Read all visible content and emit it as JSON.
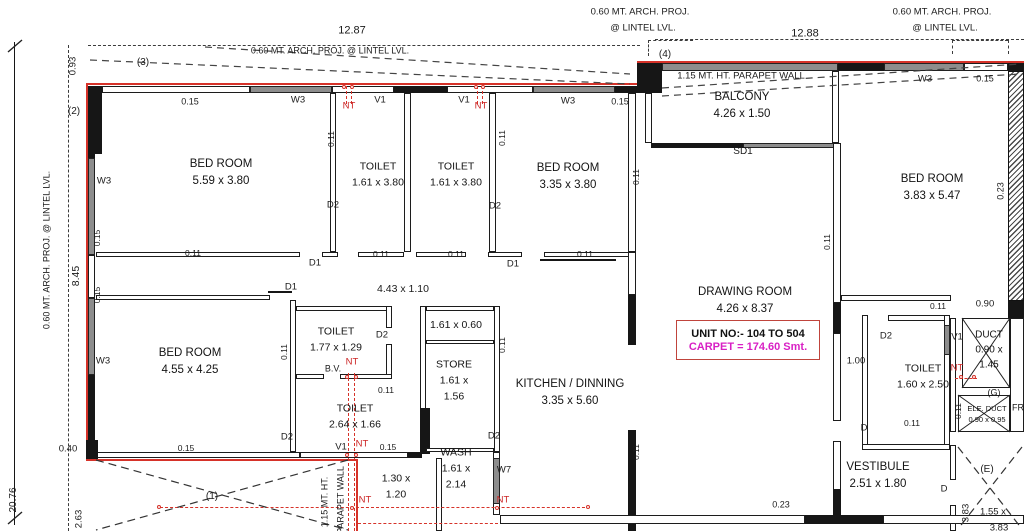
{
  "plan": {
    "unit_box": {
      "unit_no": "UNIT NO:-  104 TO 504",
      "carpet": "CARPET = 174.60 Smt."
    },
    "colors": {
      "wall_black": "#161616",
      "outer_red": "#d63229",
      "carpet_magenta": "#d81fc4",
      "window_gray": "#8d8d8d"
    },
    "rooms": [
      {
        "lines": [
          "BED ROOM",
          "5.59 x 3.80"
        ],
        "x": 221,
        "y": 173
      },
      {
        "lines": [
          "TOILET",
          "1.61 x 3.80"
        ],
        "x": 378,
        "y": 175,
        "f": 10.5
      },
      {
        "lines": [
          "TOILET",
          "1.61 x 3.80"
        ],
        "x": 456,
        "y": 175,
        "f": 10.5
      },
      {
        "lines": [
          "BED ROOM",
          "3.35 x 3.80"
        ],
        "x": 568,
        "y": 177
      },
      {
        "lines": [
          "BALCONY",
          "4.26 x 1.50"
        ],
        "x": 742,
        "y": 106
      },
      {
        "lines": [
          "DRAWING  ROOM",
          "4.26 x 8.37"
        ],
        "x": 745,
        "y": 301
      },
      {
        "lines": [
          "BED ROOM",
          "3.83 x 5.47"
        ],
        "x": 932,
        "y": 188
      },
      {
        "lines": [
          "BED ROOM",
          "4.55 x 4.25"
        ],
        "x": 190,
        "y": 362
      },
      {
        "lines": [
          "TOILET",
          "1.77 x 1.29"
        ],
        "x": 336,
        "y": 340,
        "f": 10.5
      },
      {
        "lines": [
          "TOILET",
          "2.64 x 1.66"
        ],
        "x": 355,
        "y": 417,
        "f": 10.5
      },
      {
        "lines": [
          "1.61 x 0.60"
        ],
        "x": 456,
        "y": 326,
        "f": 10.5
      },
      {
        "lines": [
          "STORE",
          "1.61 x",
          "1.56"
        ],
        "x": 454,
        "y": 381,
        "f": 10.5
      },
      {
        "lines": [
          "WASH",
          "1.61 x",
          "2.14"
        ],
        "x": 456,
        "y": 469,
        "f": 10.5
      },
      {
        "lines": [
          "1.30 x",
          "1.20"
        ],
        "x": 396,
        "y": 487,
        "f": 10.5
      },
      {
        "lines": [
          "KITCHEN / DINNING",
          "3.35 x 5.60"
        ],
        "x": 570,
        "y": 393
      },
      {
        "lines": [
          "TOILET",
          "1.60 x 2.50"
        ],
        "x": 923,
        "y": 377,
        "f": 10.5
      },
      {
        "lines": [
          "DUCT",
          "0.90 x",
          "1.45"
        ],
        "x": 989,
        "y": 350,
        "f": 10
      },
      {
        "lines": [
          "ELE. DUCT",
          "0.90 x 0.95"
        ],
        "x": 987,
        "y": 414,
        "f": 7.5
      },
      {
        "lines": [
          "VESTIBULE",
          "2.51 x 1.80"
        ],
        "x": 878,
        "y": 476
      }
    ],
    "labels": [
      {
        "t": "12.87",
        "x": 352,
        "y": 31,
        "f": 11
      },
      {
        "t": "0.60 MT. ARCH. PROJ. @ LINTEL LVL.",
        "x": 330,
        "y": 51,
        "f": 9
      },
      {
        "t": "(3)",
        "x": 143,
        "y": 63
      },
      {
        "t": "0.60 MT. ARCH. PROJ.",
        "x": 640,
        "y": 12,
        "f": 9.5
      },
      {
        "t": "@ LINTEL LVL.",
        "x": 643,
        "y": 28,
        "f": 9.5
      },
      {
        "t": "12.88",
        "x": 805,
        "y": 34,
        "f": 11
      },
      {
        "t": "(4)",
        "x": 665,
        "y": 55
      },
      {
        "t": "0.60 MT. ARCH. PROJ.",
        "x": 942,
        "y": 12,
        "f": 9.5
      },
      {
        "t": "@ LINTEL LVL.",
        "x": 945,
        "y": 28,
        "f": 9.5
      },
      {
        "t": "1.15 MT. HT. PARAPET WALL",
        "x": 741,
        "y": 76,
        "f": 9.5
      },
      {
        "t": "SD1",
        "x": 743,
        "y": 152
      },
      {
        "t": "0.93",
        "x": 73,
        "y": 66,
        "r": 1,
        "f": 9.5
      },
      {
        "t": "(2)",
        "x": 74,
        "y": 112
      },
      {
        "t": "0.15",
        "x": 190,
        "y": 102,
        "f": 9
      },
      {
        "t": "W3",
        "x": 298,
        "y": 100,
        "f": 9.5
      },
      {
        "t": "V1",
        "x": 380,
        "y": 100,
        "f": 9.5
      },
      {
        "t": "NT",
        "x": 349,
        "y": 106,
        "c": "red",
        "f": 9.5
      },
      {
        "t": "V1",
        "x": 464,
        "y": 100,
        "f": 9.5
      },
      {
        "t": "NT",
        "x": 481,
        "y": 106,
        "c": "red",
        "f": 9.5
      },
      {
        "t": "W3",
        "x": 568,
        "y": 101,
        "f": 9.5
      },
      {
        "t": "0.15",
        "x": 620,
        "y": 102,
        "f": 9
      },
      {
        "t": "W3",
        "x": 925,
        "y": 79,
        "f": 9.5
      },
      {
        "t": "0.15",
        "x": 985,
        "y": 79,
        "f": 9
      },
      {
        "t": "0.11",
        "x": 331,
        "y": 139,
        "r": 1,
        "f": 8.5
      },
      {
        "t": "0.11",
        "x": 502,
        "y": 138,
        "r": 1,
        "f": 8.5
      },
      {
        "t": "0.11",
        "x": 636,
        "y": 177,
        "r": 1,
        "f": 8.5
      },
      {
        "t": "0.11",
        "x": 827,
        "y": 242,
        "r": 1,
        "f": 8.5
      },
      {
        "t": "0.23",
        "x": 1001,
        "y": 191,
        "r": 1,
        "f": 9
      },
      {
        "t": "W3",
        "x": 104,
        "y": 181,
        "f": 9.5
      },
      {
        "t": "0.15",
        "x": 97,
        "y": 238,
        "r": 1,
        "f": 8.5
      },
      {
        "t": "8.45",
        "x": 76,
        "y": 276,
        "r": 1,
        "f": 10.5
      },
      {
        "t": "0.15",
        "x": 97,
        "y": 295,
        "r": 1,
        "f": 8.5
      },
      {
        "t": "W3",
        "x": 103,
        "y": 361,
        "f": 9.5
      },
      {
        "t": "0.60 MT. ARCH. PROJ. @ LINTEL LVL.",
        "x": 47,
        "y": 250,
        "r": 1,
        "f": 9
      },
      {
        "t": "20.76",
        "x": 14,
        "y": 500,
        "r": 1,
        "f": 10
      },
      {
        "t": "D2",
        "x": 333,
        "y": 205,
        "f": 9.5
      },
      {
        "t": "D2",
        "x": 495,
        "y": 206,
        "f": 9.5
      },
      {
        "t": "D1",
        "x": 315,
        "y": 263,
        "f": 9.5
      },
      {
        "t": "D1",
        "x": 291,
        "y": 287,
        "f": 9.5
      },
      {
        "t": "D1",
        "x": 513,
        "y": 264,
        "f": 9.5
      },
      {
        "t": "0.11",
        "x": 193,
        "y": 253,
        "f": 8.5
      },
      {
        "t": "0.11",
        "x": 381,
        "y": 254,
        "f": 8.5
      },
      {
        "t": "0.11",
        "x": 456,
        "y": 254,
        "f": 8.5
      },
      {
        "t": "0.11",
        "x": 585,
        "y": 254,
        "f": 8.5
      },
      {
        "t": "4.43 x 1.10",
        "x": 403,
        "y": 289,
        "f": 10.5
      },
      {
        "t": "D2",
        "x": 382,
        "y": 335,
        "f": 9.5
      },
      {
        "t": "B.V.",
        "x": 333,
        "y": 369,
        "f": 9
      },
      {
        "t": "NT",
        "x": 352,
        "y": 362,
        "c": "red",
        "f": 9.5
      },
      {
        "t": "0.11",
        "x": 284,
        "y": 352,
        "r": 1,
        "f": 8.5
      },
      {
        "t": "0.11",
        "x": 502,
        "y": 345,
        "r": 1,
        "f": 8.5
      },
      {
        "t": "0.11",
        "x": 386,
        "y": 390,
        "f": 8.5
      },
      {
        "t": "V1",
        "x": 341,
        "y": 447,
        "f": 9.5
      },
      {
        "t": "NT",
        "x": 362,
        "y": 444,
        "c": "red",
        "f": 9.5
      },
      {
        "t": "0.15",
        "x": 388,
        "y": 447,
        "f": 8.5
      },
      {
        "t": "0.15",
        "x": 186,
        "y": 448,
        "f": 8.5
      },
      {
        "t": "D2",
        "x": 287,
        "y": 437,
        "f": 9.5
      },
      {
        "t": "D2",
        "x": 494,
        "y": 436,
        "f": 9.5
      },
      {
        "t": "W7",
        "x": 504,
        "y": 470,
        "f": 9.5
      },
      {
        "t": "NT",
        "x": 365,
        "y": 500,
        "c": "red",
        "f": 9.5
      },
      {
        "t": "NT",
        "x": 503,
        "y": 500,
        "c": "red",
        "f": 9.5
      },
      {
        "t": "0.40",
        "x": 68,
        "y": 449,
        "f": 9.5
      },
      {
        "t": "2.63",
        "x": 79,
        "y": 519,
        "r": 1,
        "f": 9.5
      },
      {
        "t": "(1)",
        "x": 212,
        "y": 497
      },
      {
        "t": "1.15 MT. HT.",
        "x": 325,
        "y": 502,
        "r": 1,
        "f": 9
      },
      {
        "t": "PARAPET WALL",
        "x": 341,
        "y": 500,
        "r": 1,
        "f": 9
      },
      {
        "t": "0.11",
        "x": 636,
        "y": 452,
        "r": 1,
        "f": 8.5
      },
      {
        "t": "0.23",
        "x": 781,
        "y": 505,
        "f": 9
      },
      {
        "t": "0.11",
        "x": 938,
        "y": 306,
        "f": 8.5
      },
      {
        "t": "0.90",
        "x": 985,
        "y": 304,
        "f": 9.5
      },
      {
        "t": "D2",
        "x": 886,
        "y": 336,
        "f": 9.5
      },
      {
        "t": "V1",
        "x": 957,
        "y": 337,
        "f": 9.5
      },
      {
        "t": "NT",
        "x": 957,
        "y": 368,
        "c": "red",
        "f": 9.5
      },
      {
        "t": "1.00",
        "x": 856,
        "y": 361,
        "f": 9.5
      },
      {
        "t": "0.11",
        "x": 958,
        "y": 411,
        "r": 1,
        "f": 8.5
      },
      {
        "t": "0.11",
        "x": 912,
        "y": 423,
        "f": 8.5
      },
      {
        "t": "D",
        "x": 864,
        "y": 428,
        "f": 9.5
      },
      {
        "t": "(G)",
        "x": 994,
        "y": 393,
        "f": 9
      },
      {
        "t": "FR",
        "x": 1018,
        "y": 408,
        "f": 9
      },
      {
        "t": "D",
        "x": 944,
        "y": 489,
        "f": 9.5
      },
      {
        "t": "(E)",
        "x": 987,
        "y": 470
      },
      {
        "t": "3.83",
        "x": 966,
        "y": 513,
        "r": 1,
        "f": 9.5
      },
      {
        "t": "1.55 x",
        "x": 993,
        "y": 512,
        "f": 9.5
      },
      {
        "t": "3.83",
        "x": 999,
        "y": 528,
        "f": 9.5
      }
    ]
  }
}
